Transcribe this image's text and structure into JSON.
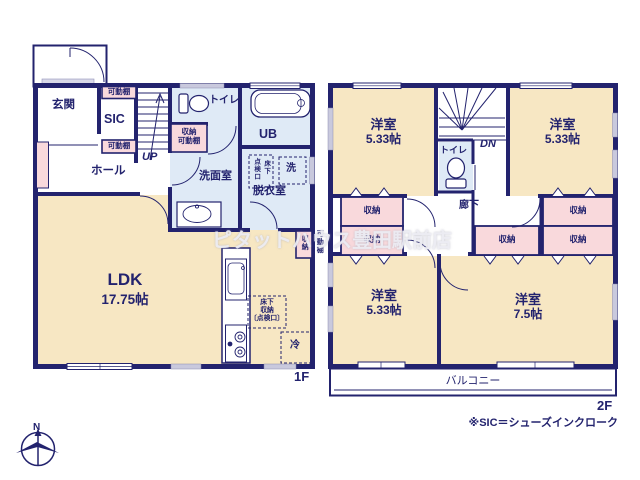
{
  "watermark": "ピタットハウス豊田駅前店",
  "note": "※SIC＝シューズインクローク",
  "compass_north": "N",
  "colors": {
    "wall_navy": "#23236e",
    "room_cream": "#f7e7c3",
    "wet_blue": "#dfeaf6",
    "closet_pink": "#f9d9dc",
    "window_gray": "#c9c9dd"
  },
  "floor1": {
    "floor_label": "1F",
    "entrance": "玄関",
    "sic": "SIC",
    "shelf_top": "可動棚",
    "shelf_bottom": "可動棚",
    "hall": "ホール",
    "up": "UP",
    "toilet": "トイレ",
    "storage_shelf_line1": "収納",
    "storage_shelf_line2": "可動棚",
    "washroom": "洗面室",
    "unit_bath": "UB",
    "dressing": "脱衣室",
    "washer": "洗",
    "hatch_col_left": "点検口",
    "hatch_col_right": "床下",
    "ldk": "LDK",
    "ldk_size": "17.75帖",
    "floor_storage_l1": "床下",
    "floor_storage_l2": "収納",
    "floor_storage_l3": "〔点検口〕",
    "fridge": "冷",
    "side_closet": "収納",
    "side_closet_shelf": "可動棚"
  },
  "floor2": {
    "floor_label": "2F",
    "dn": "DN",
    "toilet": "トイレ",
    "corridor": "廊下",
    "balcony": "バルコニー",
    "room_tl": {
      "name": "洋室",
      "size": "5.33帖"
    },
    "room_tr": {
      "name": "洋室",
      "size": "5.33帖"
    },
    "room_bl": {
      "name": "洋室",
      "size": "5.33帖"
    },
    "room_br": {
      "name": "洋室",
      "size": "7.5帖"
    },
    "closets": [
      "収納",
      "収納",
      "収納",
      "収納",
      "収納"
    ]
  }
}
